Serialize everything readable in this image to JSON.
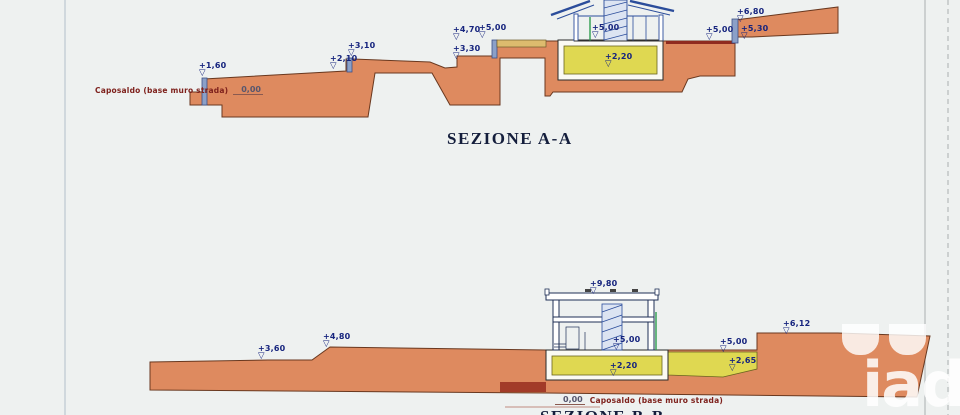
{
  "page": {
    "background": "#eef1f0"
  },
  "watermark": {
    "text": "iad"
  },
  "colors": {
    "terrain": "#de8a5f",
    "terrain_outline": "#69381f",
    "basement_yellow": "#dfd851",
    "building_blue": "#2b4d9b",
    "label_blue": "#16247e",
    "caposaldo_red": "#7e211c",
    "courtyard_tan": "#ddbb6e"
  },
  "section_a": {
    "title": "SEZIONE A-A",
    "caposaldo_label": "Caposaldo (base muro strada)",
    "caposaldo_value": "0,00",
    "markers": [
      {
        "label": "+1,60",
        "x": 199,
        "y": 62
      },
      {
        "label": "+2,10",
        "x": 330,
        "y": 55
      },
      {
        "label": "+3,10",
        "x": 348,
        "y": 42
      },
      {
        "label": "+4,70",
        "x": 453,
        "y": 26
      },
      {
        "label": "+5,00",
        "x": 479,
        "y": 24
      },
      {
        "label": "+3,30",
        "x": 453,
        "y": 45
      },
      {
        "label": "+5,00",
        "x": 592,
        "y": 24
      },
      {
        "label": "+2,20",
        "x": 605,
        "y": 53
      },
      {
        "label": "+5,00",
        "x": 706,
        "y": 26
      },
      {
        "label": "+6,80",
        "x": 737,
        "y": 8
      },
      {
        "label": "+5,30",
        "x": 741,
        "y": 25
      }
    ]
  },
  "section_b": {
    "title": "SEZIONE B-B",
    "caposaldo_label": "Caposaldo (base muro strada)",
    "caposaldo_value": "0,00",
    "markers": [
      {
        "label": "+3,60",
        "x": 258,
        "y": 345
      },
      {
        "label": "+4,80",
        "x": 323,
        "y": 333
      },
      {
        "label": "+9,80",
        "x": 590,
        "y": 280
      },
      {
        "label": "+5,00",
        "x": 613,
        "y": 336
      },
      {
        "label": "+2,20",
        "x": 610,
        "y": 362
      },
      {
        "label": "+5,00",
        "x": 720,
        "y": 338
      },
      {
        "label": "+2,65",
        "x": 729,
        "y": 357
      },
      {
        "label": "+6,12",
        "x": 783,
        "y": 320
      }
    ]
  }
}
